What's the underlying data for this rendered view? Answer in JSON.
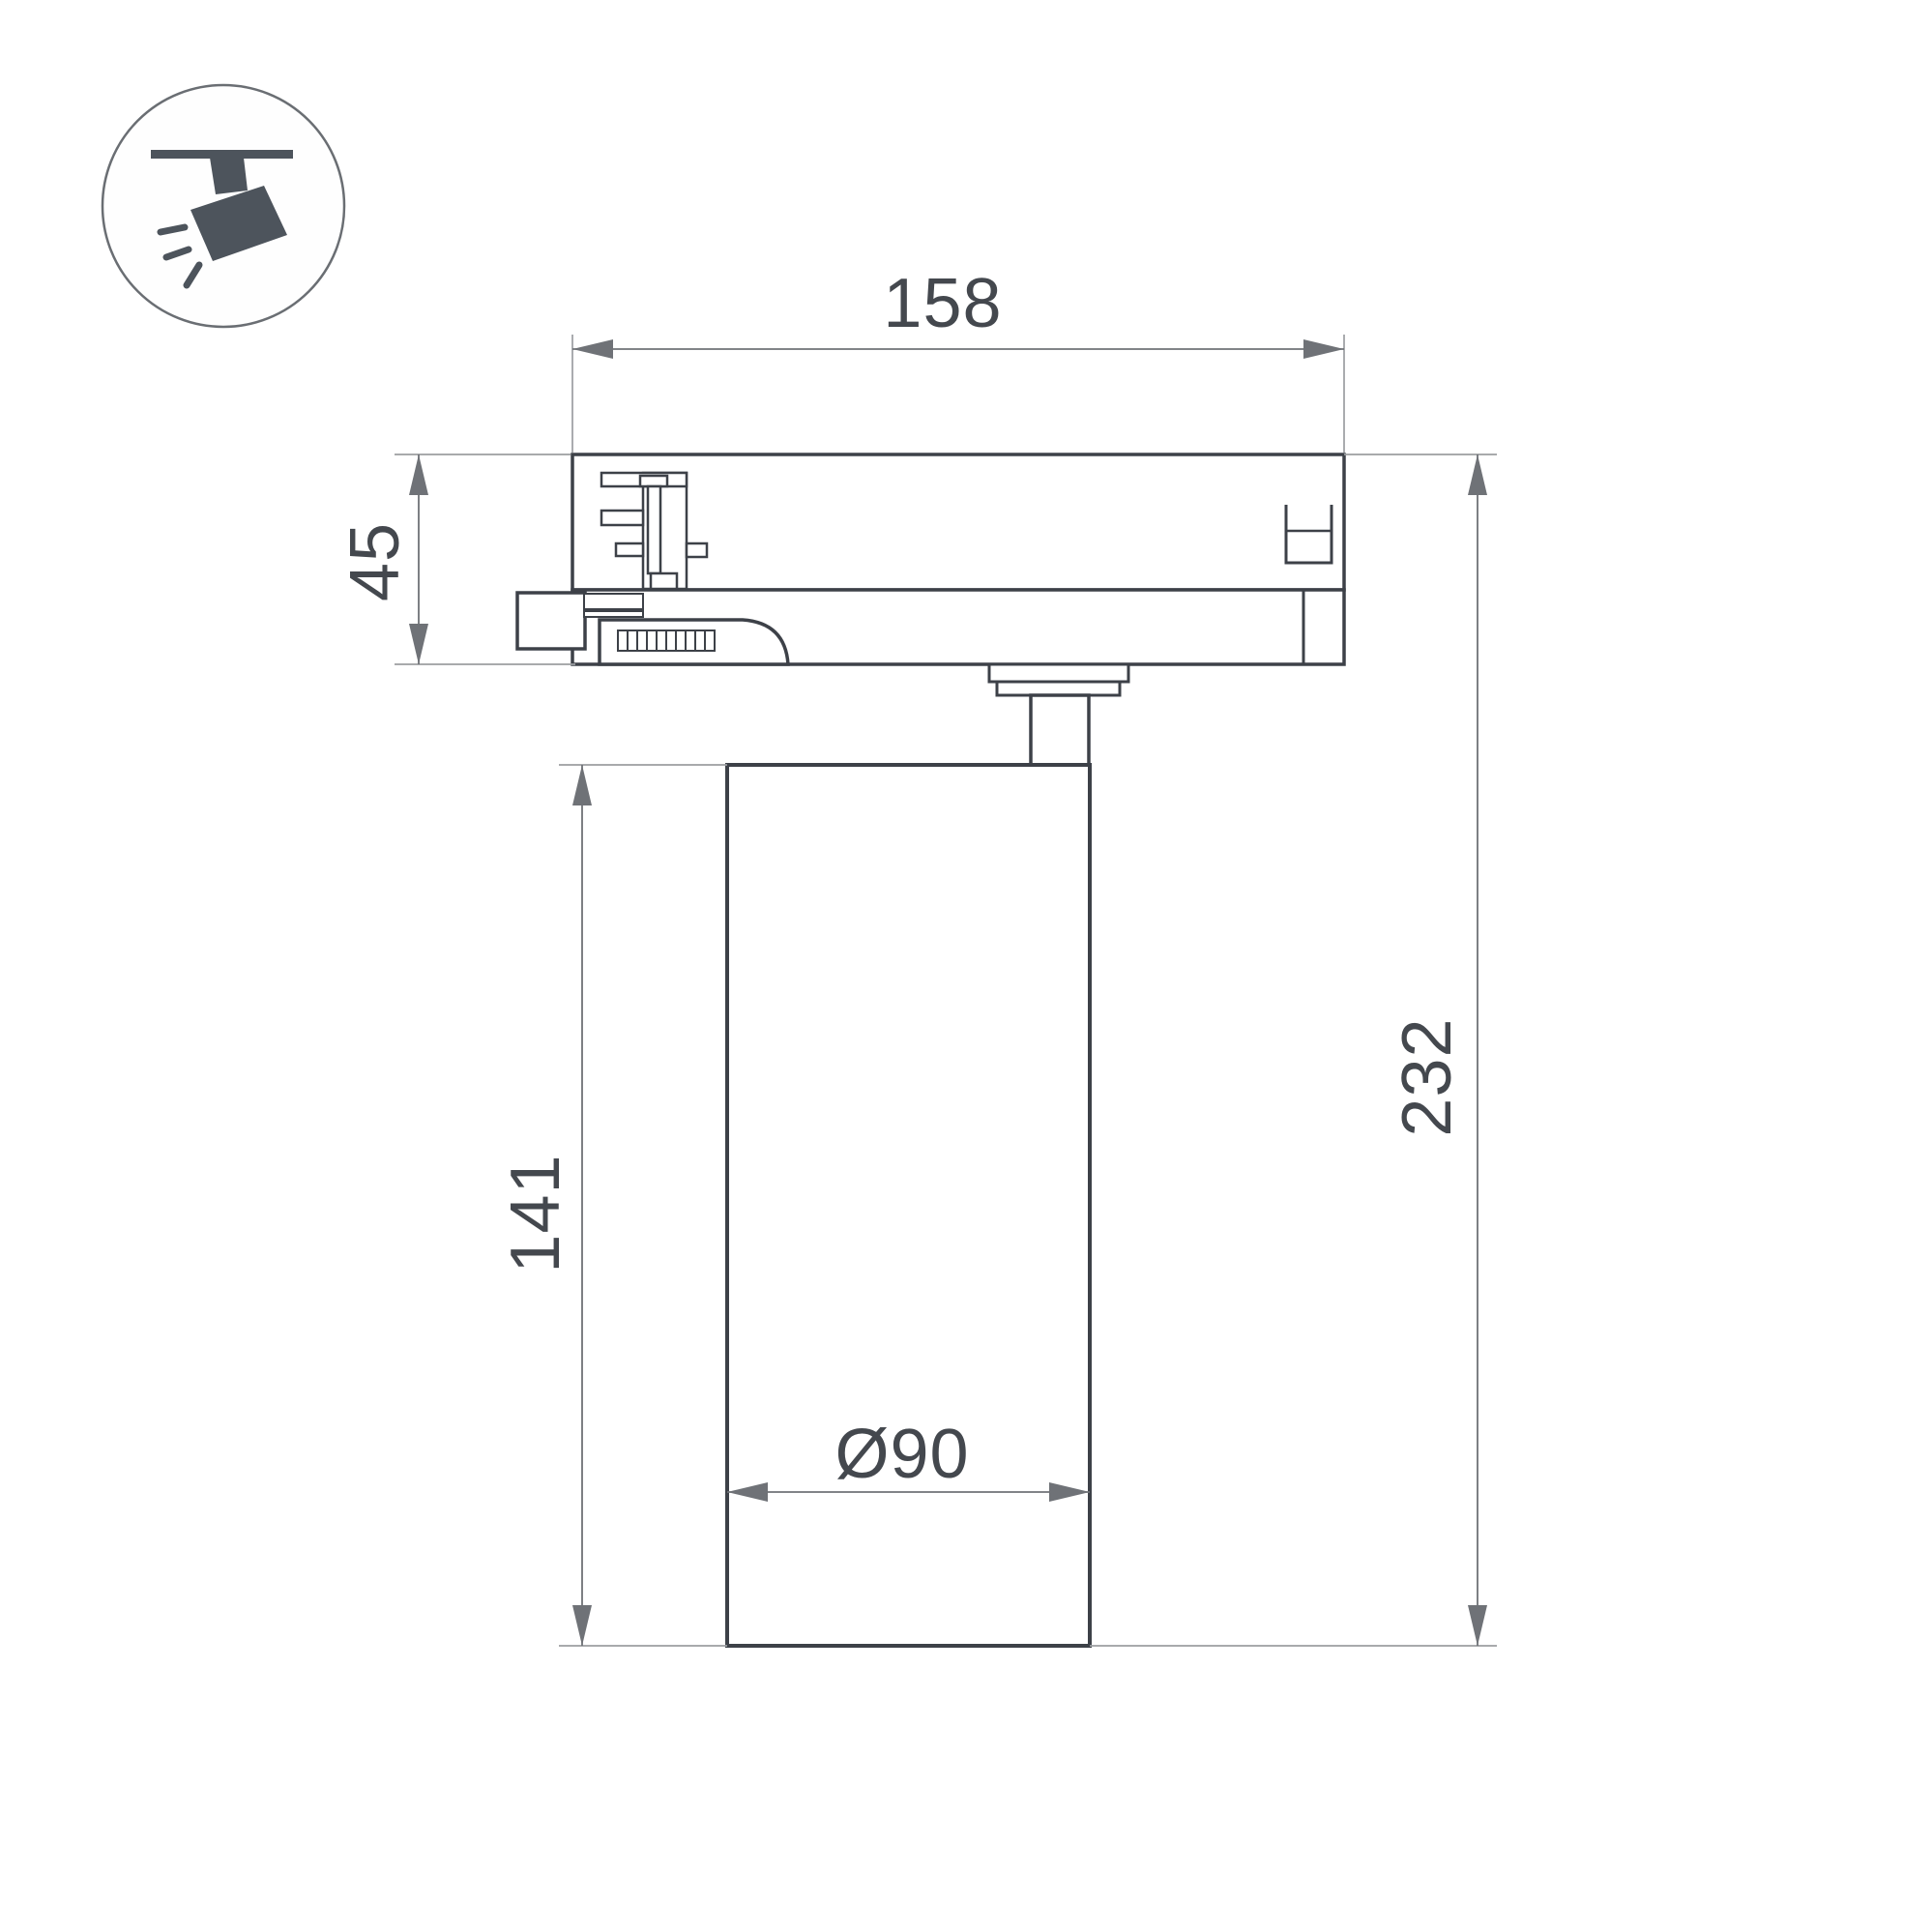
{
  "title": "Track spotlight dimension drawing",
  "icon": {
    "label": "track-spotlight"
  },
  "dimensions": {
    "adapter_width": "158",
    "adapter_height": "45",
    "body_height": "141",
    "total_height": "232",
    "body_diameter": "Ø90"
  },
  "colors": {
    "background": "#ffffff",
    "line_dark": "#3d4148",
    "line_dim": "#6f7277",
    "line_ext": "#9b9ea1",
    "text": "#44484e",
    "icon_fill": "#4d545c"
  }
}
